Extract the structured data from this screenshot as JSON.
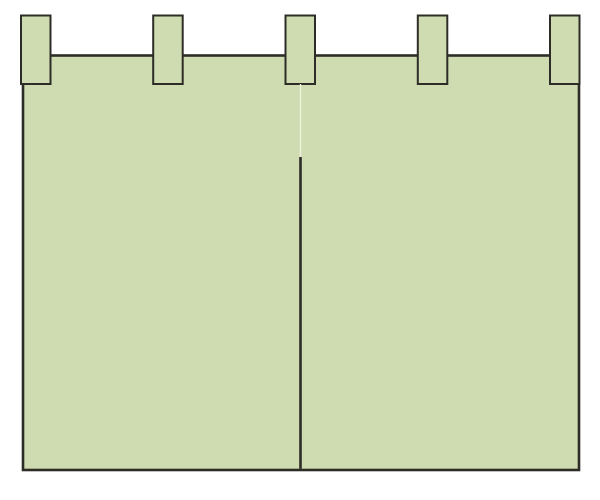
{
  "canvas": {
    "width": 600,
    "height": 500,
    "background": "#ffffff"
  },
  "colors": {
    "curtain-fill": "#cfdbb0",
    "curtain-stroke": "#2d2c27",
    "seam-highlight": "#edf2dd"
  },
  "illustration": {
    "subject": "noren-curtain",
    "body": {
      "x": 23,
      "y": 55.5,
      "width": 556,
      "height": 414.5,
      "stroke_width": 2.6
    },
    "tabs": {
      "count": 5,
      "xs": [
        21,
        153.2,
        285.5,
        417.8,
        550
      ],
      "y": 15.5,
      "width": 29.5,
      "height": 68.5,
      "stroke_width": 2
    },
    "slit": {
      "x": 300.5,
      "highlight_y1": 84,
      "highlight_y2": 157,
      "highlight_width": 1.4,
      "dark_y1": 157,
      "dark_y2": 468.7,
      "dark_width": 2.6
    }
  }
}
